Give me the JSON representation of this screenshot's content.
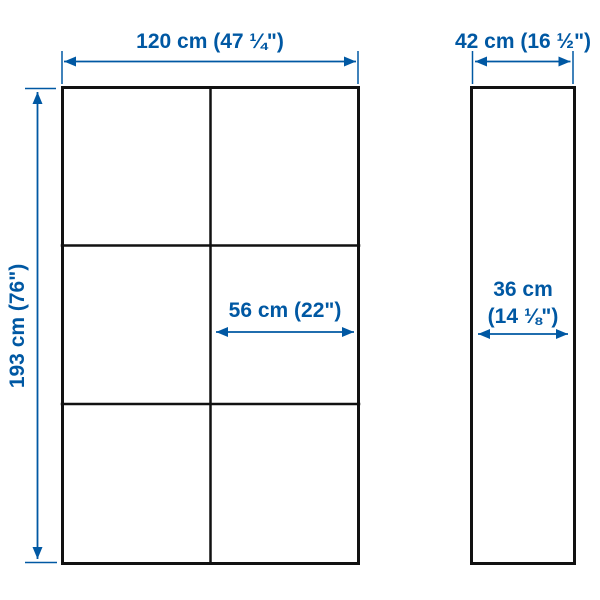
{
  "colors": {
    "accent": "#0058a3",
    "line": "#111111",
    "background": "#ffffff"
  },
  "front_view": {
    "width_label": "120 cm (47 ¼\")",
    "height_label": "193 cm (76\")",
    "cell_width_label": "56 cm (22\")",
    "columns": 2,
    "rows": 3
  },
  "side_view": {
    "depth_label": "42 cm (16 ½\")",
    "inner_depth_label_line1": "36 cm",
    "inner_depth_label_line2": "(14 ⅛\")"
  }
}
